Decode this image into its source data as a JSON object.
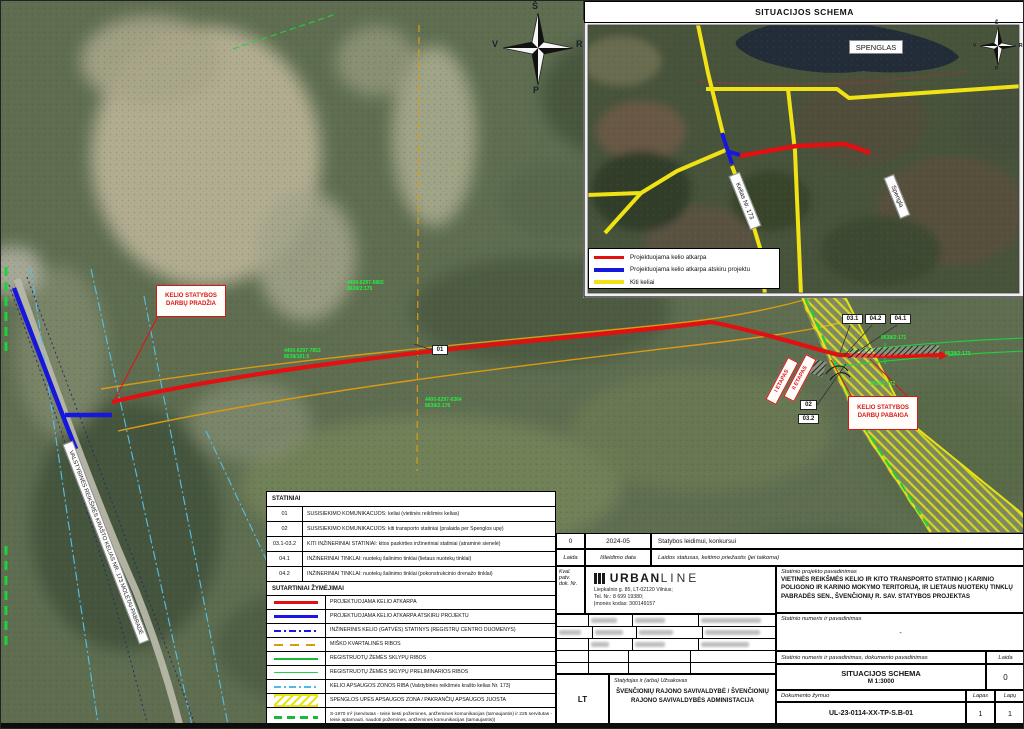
{
  "colors": {
    "proposed_road_red": "#e21010",
    "separate_project_blue": "#1616dd",
    "other_roads_yellow": "#f0e214",
    "parcel_green": "#1ed13e",
    "forest_border_orange": "#dc9a14",
    "protection_zone_cyan": "#55c0ea"
  },
  "inset": {
    "title": "SITUACIJOS SCHEMA",
    "lake_label": "SPENGLAS",
    "road_label": "Kelias Nr. 173",
    "river_label": "Spengla",
    "legend": [
      {
        "label": "Projektuojama kelio atkarpa"
      },
      {
        "label": "Projektuojama kelio atkarpa atskiru projektu"
      },
      {
        "label": "Kiti keliai"
      }
    ],
    "compass": {
      "n": "Š",
      "w": "V",
      "e": "R",
      "s": "P"
    }
  },
  "map": {
    "compass": {
      "n": "Š",
      "w": "V",
      "e": "R",
      "s": "P"
    },
    "start_label": "KELIO STATYBOS\nDARBŲ PRADŽIA",
    "end_label": "KELIO STATYBOS\nDARBŲ PABAIGA",
    "stage1": "I ETAPAS",
    "stage2": "II ETAPAS",
    "road_name": "VALSTYBINĖS REIKŠMĖS KRAŠTO KELIAS NR. 173 MOLĖTAI-PABRADĖ",
    "markers": {
      "m01": "01",
      "m02": "02",
      "m03_1": "03.1",
      "m03_2": "03.2",
      "m04_1": "04.1",
      "m04_2": "04.2"
    },
    "parcels": {
      "p1": "4400-6297-5865\n8638/2:175",
      "p2": "4400-6297-7853\n8638/181:5",
      "p3": "4400-6297-6364\n8638/2:176",
      "p4": "8638/2:171",
      "p5": "8638/2:173",
      "p6": "8638/2:172"
    }
  },
  "statiniai": {
    "title": "STATINIAI",
    "rows": [
      {
        "code": "01",
        "desc": "SUSISIEKIMO KOMUNIKACIJOS: keliai (vietinės reikšmės kelias)"
      },
      {
        "code": "02",
        "desc": "SUSISIEKIMO KOMUNIKACIJOS: kiti transporto statiniai (pralaida per Spenglos upę)"
      },
      {
        "code": "03.1-03.2",
        "desc": "KITI INŽINERINIAI STATINIAI: kitos paskirties inžineriniai statiniai (atraminė sienelė)"
      },
      {
        "code": "04.1",
        "desc": "INŽINERINIAI TINKLAI: nuotekų šalinimo tinklai (lietaus nuotekų tinklai)"
      },
      {
        "code": "04.2",
        "desc": "INŽINERINIAI TINKLAI: nuotekų šalinimo tinklai (pokonstrukcinio drenažo tinklai)"
      }
    ]
  },
  "symbols": {
    "title": "SUTARTINIAI ŽYMĖJIMAI",
    "rows": [
      "PROJEKTUOJAMA KELIO ATKARPA",
      "PROJEKTUOJAMA KELIO ATKARPA ATSKIRU PROJEKTU",
      "INŽINERINIS KELIO (GATVĖS) STATINYS (REGISTRŲ CENTRO DUOMENYS)",
      "MIŠKO KVARTALINĖS RIBOS",
      "REGISTRUOTŲ ŽEMĖS SKLYPŲ RIBOS",
      "REGISTRUOTŲ ŽEMĖS SKLYPŲ PRELIMINARIOS RIBOS",
      "KELIO APSAUGOS ZONOS RIBA (Valstybinės reikšmės krašto kelias Nr. 173)",
      "SPENGLOS UPĖS APSAUGOS ZONA / PAKRANČIŲ APSAUGOS JUOSTA",
      "S-1970 m² (servitutas - teisė tiesti požemines, antžemines komunikacijas (tarnaujantis) ir 225 servitutas - teisė aptarnauti, naudoti požemines, antžemines komunikacijas (tarnaujantis))",
      "UŽSTATYMO PLOTAS"
    ]
  },
  "titleblock": {
    "revision": "0",
    "date": "2024-05",
    "status": "Statybos leidimui, konkursui",
    "laida_label": "Laida",
    "date_label": "Išleidimo data",
    "status_label": "Laidos statusas, keitimo priežastis (jei taikoma)",
    "kval_label": "Kval.\npatv.\ndok. Nr.",
    "company_bold": "URBAN",
    "company_light": "LINE",
    "address": "Liepkalnio g. 85, LT-02120 Vilnius;\nTel. Nr.: 8 699 19380;\nĮmonės kodas: 300149157",
    "project_label": "Statinio projekto pavadinimas",
    "project_name": "VIETINĖS REIKŠMĖS KELIO IR KITO TRANSPORTO STATINIO Į KARINIO POLIGONO IR KARINIO MOKYMO TERITORIJĄ, IR LIETAUS NUOTEKŲ TINKLŲ PABRADĖS SEN., ŠVENČIONIŲ R. SAV. STATYBOS PROJEKTAS",
    "building_label": "Statinio numeris ir pavadinimas",
    "building_value": "-",
    "doc_label": "Statinio numeris ir pavadinimas, dokumento pavadinimas",
    "doc_laida_label": "Laida",
    "doc_title": "SITUACIJOS SCHEMA",
    "doc_scale": "M 1:3000",
    "doc_laida_value": "0",
    "zymuo_label": "Dokumento žymuo",
    "zymuo_value": "UL-23-0114-XX-TP-S.B-01",
    "lapas_label": "Lapas",
    "lapu_label": "Lapų",
    "lapas_value": "1",
    "lapu_value": "1",
    "client_label": "Statytojas ir (arba) Užsakovas",
    "client_name": "ŠVENČIONIŲ RAJONO SAVIVALDYBĖ / ŠVENČIONIŲ RAJONO SAVIVALDYBĖS ADMINISTACIJA",
    "lt_label": "LT"
  }
}
